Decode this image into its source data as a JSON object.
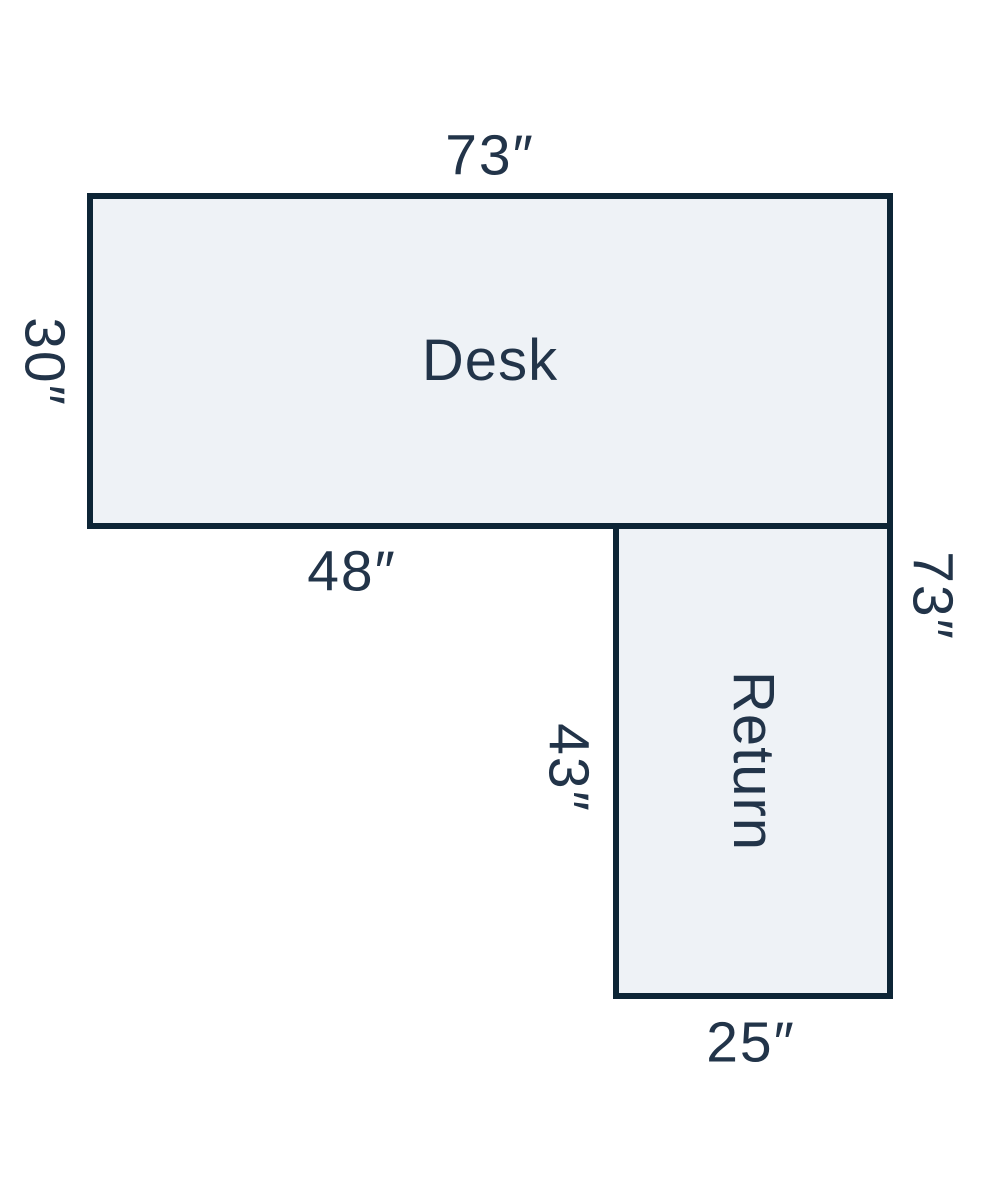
{
  "diagram": {
    "description": "L-shaped desk footprint diagram with dimension labels in inches",
    "colors": {
      "outline": "#0d2536",
      "fill": "#eef2f6",
      "text": "#223449",
      "background": "#ffffff"
    },
    "desk": {
      "title": "Desk",
      "top_width": "73″",
      "left_depth": "30″",
      "bottom_left_width": "48″"
    },
    "return": {
      "title": "Return",
      "left_length": "43″",
      "right_total_length": "73″",
      "bottom_width": "25″"
    }
  }
}
